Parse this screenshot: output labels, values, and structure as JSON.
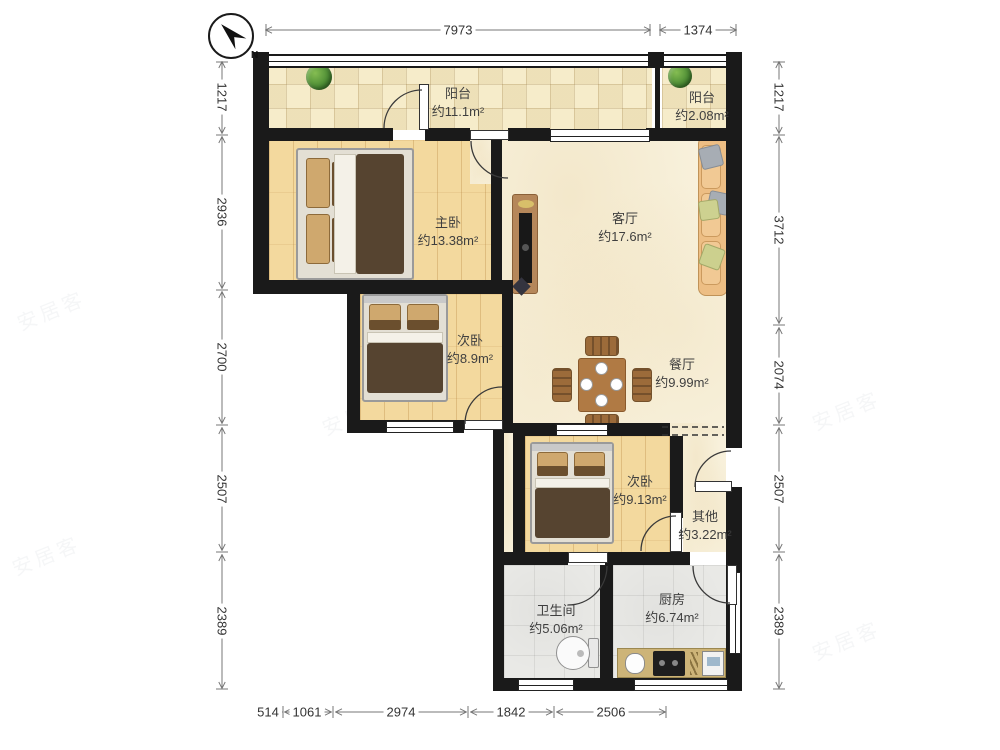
{
  "compass": {
    "label": "N"
  },
  "rooms": [
    {
      "name": "阳台",
      "area": "约11.1m²"
    },
    {
      "name": "阳台",
      "area": "约2.08m²"
    },
    {
      "name": "主卧",
      "area": "约13.38m²"
    },
    {
      "name": "客厅",
      "area": "约17.6m²"
    },
    {
      "name": "次卧",
      "area": "约8.9m²"
    },
    {
      "name": "餐厅",
      "area": "约9.99m²"
    },
    {
      "name": "次卧",
      "area": "约9.13m²"
    },
    {
      "name": "其他",
      "area": "约3.22m²"
    },
    {
      "name": "卫生间",
      "area": "约5.06m²"
    },
    {
      "name": "厨房",
      "area": "约6.74m²"
    }
  ],
  "dimensions": {
    "top": [
      "7973",
      "1374"
    ],
    "bottom": [
      "514",
      "1061",
      "2974",
      "1842",
      "2506"
    ],
    "left": [
      "1217",
      "2936",
      "2700",
      "2507",
      "2389"
    ],
    "right": [
      "1217",
      "3712",
      "2074",
      "2507",
      "2389"
    ]
  },
  "watermark": {
    "text": "安居客"
  },
  "colors": {
    "wall": "#1a1a1a",
    "wood_floor": "#f3d99e",
    "balcony_tile": "#f6ecca",
    "marble_floor": "#f8f1dc",
    "grey_tile": "#e9e9e6",
    "dimension_line": "#777777"
  }
}
